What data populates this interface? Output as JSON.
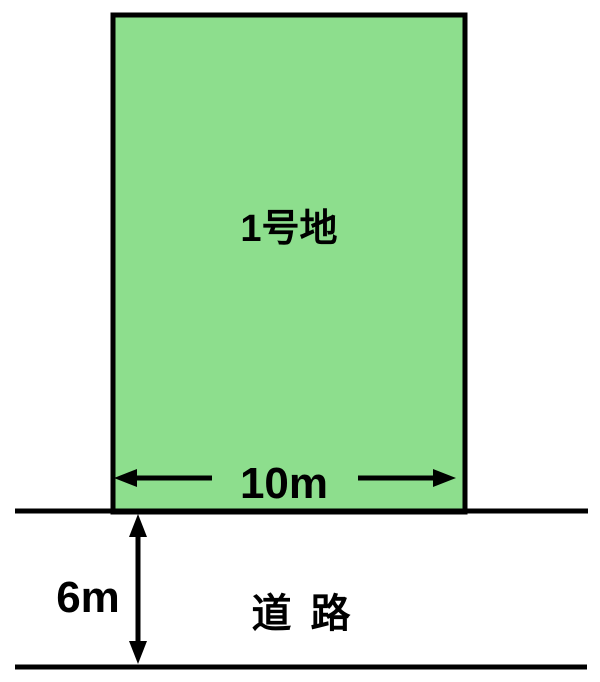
{
  "diagram": {
    "title": "land-plot-and-road-diagram",
    "lot": {
      "label": "1号地",
      "frontage_label": "10m"
    },
    "road": {
      "label": "道 路",
      "width_label": "6m"
    },
    "colors": {
      "lot_fill": "#8DDE8D",
      "line": "#000000",
      "background": "#FFFFFF"
    }
  }
}
